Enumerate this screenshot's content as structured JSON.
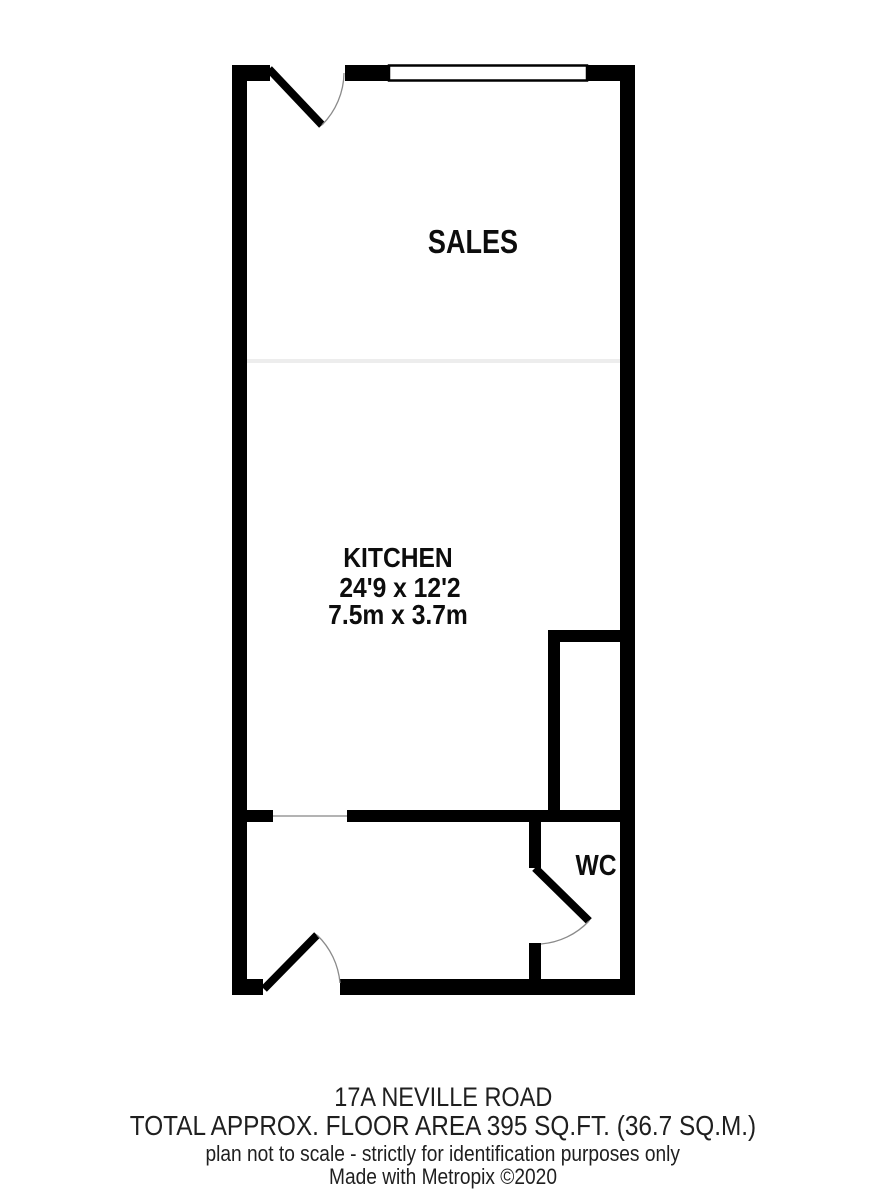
{
  "plan": {
    "rooms": [
      {
        "name": "SALES"
      },
      {
        "name": "KITCHEN",
        "dims_imperial": "24'9 x 12'2",
        "dims_metric": "7.5m x 3.7m"
      },
      {
        "name": "WC"
      }
    ],
    "features": [
      "window-top-wall",
      "door-top-left",
      "door-bottom-left",
      "wc-door",
      "open-doorway-kitchen-to-hall",
      "closet-right-side",
      "faint-divider-sales-kitchen"
    ]
  },
  "footer": {
    "address": "17A NEVILLE ROAD",
    "area": "TOTAL APPROX. FLOOR AREA 395 SQ.FT. (36.7 SQ.M.)",
    "disclaimer": "plan not to scale - strictly for identification purposes only",
    "credit": "Made with Metropix ©2020"
  },
  "colors": {
    "wall": "#000000",
    "background": "#ffffff",
    "label_text": "#0d0d0d",
    "footer_text": "#1f1f1f",
    "door_swing_arc": "#8a8a8a",
    "faint_divider": "#e9e9e9"
  }
}
